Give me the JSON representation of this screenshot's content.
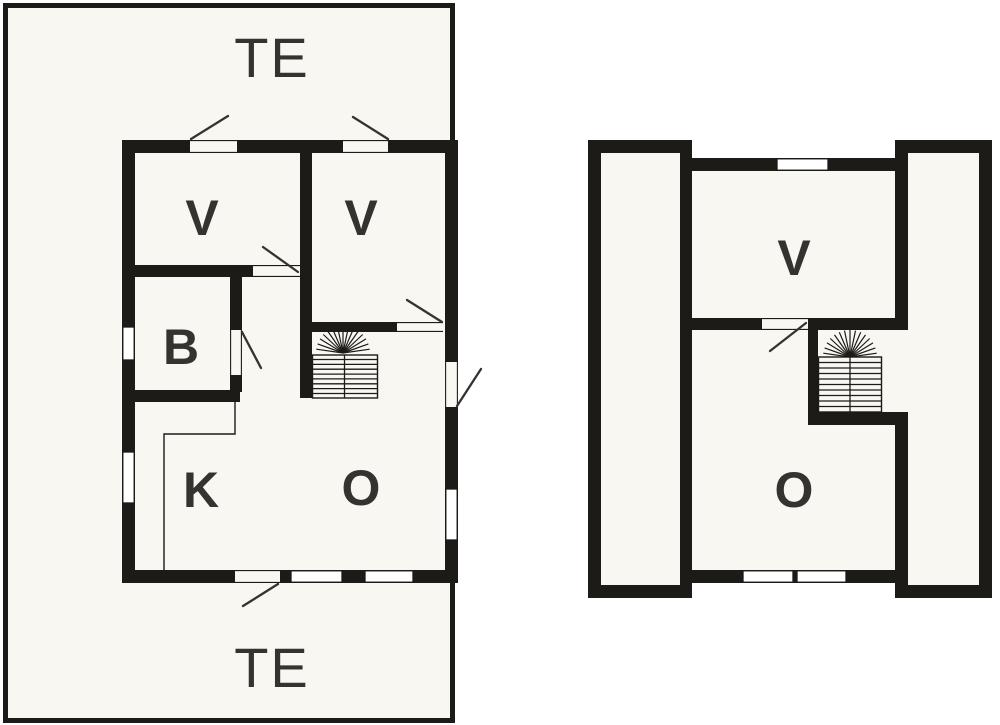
{
  "colors": {
    "wall": "#1d1b18",
    "floor": "#f8f7f1",
    "window": "#ffffff",
    "line": "#35332f",
    "page": "#ffffff"
  },
  "ground_floor": {
    "terrace_label_top": "TE",
    "terrace_label_bottom": "TE",
    "room_labels": {
      "bedroom_left": "V",
      "bedroom_right": "V",
      "bathroom": "B",
      "kitchen": "K",
      "living_room": "O"
    }
  },
  "upper_floor": {
    "room_labels": {
      "bedroom": "V",
      "landing": "O"
    }
  }
}
